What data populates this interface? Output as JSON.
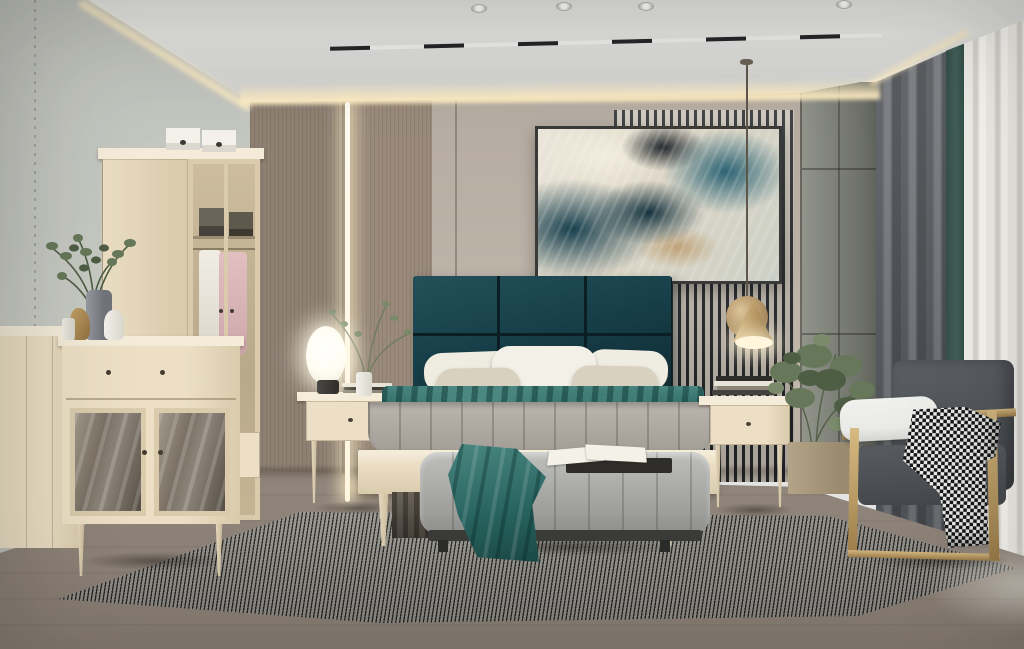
{
  "scene": {
    "description": "Photorealistic render of a modern bedroom: light wood furniture set, deep teal upholstered headboard, abstract teal-and-cream wall art over a slatted accent wall, glowing cove ceiling, gray channel-tufted bench, brass-framed gray armchair with houndstooth throw, striped area rug, gray curtains with bright sheer",
    "room_type": "bedroom",
    "style": "modern light-wood with teal accents"
  },
  "objects": [
    {
      "name": "ceiling-cove",
      "label": "recessed tray ceiling with warm cove lighting"
    },
    {
      "name": "track-light",
      "label": "black linear track light"
    },
    {
      "name": "spotlights",
      "label": "round recessed spotlights"
    },
    {
      "name": "wall-art",
      "label": "framed abstract painting in teal, cream and gold"
    },
    {
      "name": "slat-wall",
      "label": "dark vertical slat accent wall"
    },
    {
      "name": "wood-panel-wall",
      "label": "taupe wood panels with vertical LED light strip"
    },
    {
      "name": "headboard",
      "label": "deep teal six-panel upholstered headboard"
    },
    {
      "name": "bed",
      "label": "light wood bed with gray channel duvet and teal runner"
    },
    {
      "name": "pillows",
      "label": "white and cream pillows"
    },
    {
      "name": "bench",
      "label": "gray channel-stitched bench with teal throw and open book"
    },
    {
      "name": "rug",
      "label": "fine black-and-white striped area rug"
    },
    {
      "name": "nightstand-left",
      "label": "wood nightstand with glowing oval table lamp and branch vase"
    },
    {
      "name": "nightstand-right",
      "label": "wood nightstand with book stack under brass pendant"
    },
    {
      "name": "pendant-lamp",
      "label": "brass cone-and-disc pendant light"
    },
    {
      "name": "wardrobe",
      "label": "light wood wardrobe, glass display door with white and pink garments, boxes on top"
    },
    {
      "name": "dresser",
      "label": "light wood dresser with smoked-glass doors, plant, vases and figurine"
    },
    {
      "name": "sideboard",
      "label": "low light wood sideboard at far left"
    },
    {
      "name": "armchair",
      "label": "slate gray armchair with brass frame, white arm cushion, houndstooth throw"
    },
    {
      "name": "curtains",
      "label": "gray blackout curtain with teal fold and bright sheer panel"
    },
    {
      "name": "plants",
      "label": "green branch arrangements and potted shrub"
    },
    {
      "name": "floor",
      "label": "gray-brown wood plank floor"
    }
  ],
  "palette": {
    "ceiling_a": "#e4e4e2",
    "ceiling_b": "#cfcfcd",
    "cove": "#ffedc2",
    "wall_left_a": "#c8cac4",
    "wall_left_b": "#bfc1bb",
    "wood_a": "#8e8073",
    "wood_b": "#998a7b",
    "led": "#fff6e0",
    "beige_a": "#b5aca1",
    "beige_b": "#c0b7ab",
    "slat_dark": "#24262b",
    "slat_light": "#cac2b6",
    "corner_a": "#91948b",
    "corner_b": "#6e7168",
    "curt_a": "#5a5d62",
    "curt_b": "#787b80",
    "curt_teal": "#436059",
    "sheer_a": "#f6f4ee",
    "sheer_b": "#dbd9d1",
    "floor_a": "#a69b90",
    "floor_b": "#8a7f75",
    "rug_light": "#c8c5be",
    "rug_dark": "#34332e",
    "furn_a": "#ecdfc5",
    "furn_b": "#d9cbac",
    "furn_edge": "#f4ecd9",
    "furn_dark": "#c4b493",
    "glass_a": "#a29a8c",
    "glass_b": "#564f45",
    "hb_a": "#245059",
    "hb_b": "#0f2a32",
    "hb_seam": "#0a1e24",
    "pillow_a": "#efece2",
    "pillow_b": "#d9d1bf",
    "duvet_a": "#bab6af",
    "duvet_b": "#a5a19a",
    "teal_a": "#4a8680",
    "teal_b": "#2a6561",
    "teal_c": "#1b4a47",
    "bench_a": "#bebfbc",
    "bench_b": "#9d9e9b",
    "base_dark": "#3b3c39",
    "chair_a": "#5d6066",
    "chair_b": "#45484d",
    "white_cushion": "#eaeae7",
    "brass_a": "#d7ba82",
    "brass_b": "#9e7f4b",
    "hound_dark": "#15171b",
    "hound_light": "#edece8",
    "plant_a": "#67785a",
    "plant_b": "#4e5e44",
    "plant_c": "#7b8a6b",
    "art_cream": "#ebe6da",
    "art_teal1": "#2a6273",
    "art_teal2": "#173f4d",
    "art_dark": "#20262a",
    "art_gold": "#bfa379",
    "lamp_glow": "#fffdf2",
    "cord": "#5e564b",
    "book_dark": "#2e2d29",
    "book_light": "#e8e4d8",
    "book_mid": "#8d8678",
    "garment_white": "#f0ede5",
    "garment_pink": "#e2bfc1",
    "planter": "#b3a387"
  }
}
